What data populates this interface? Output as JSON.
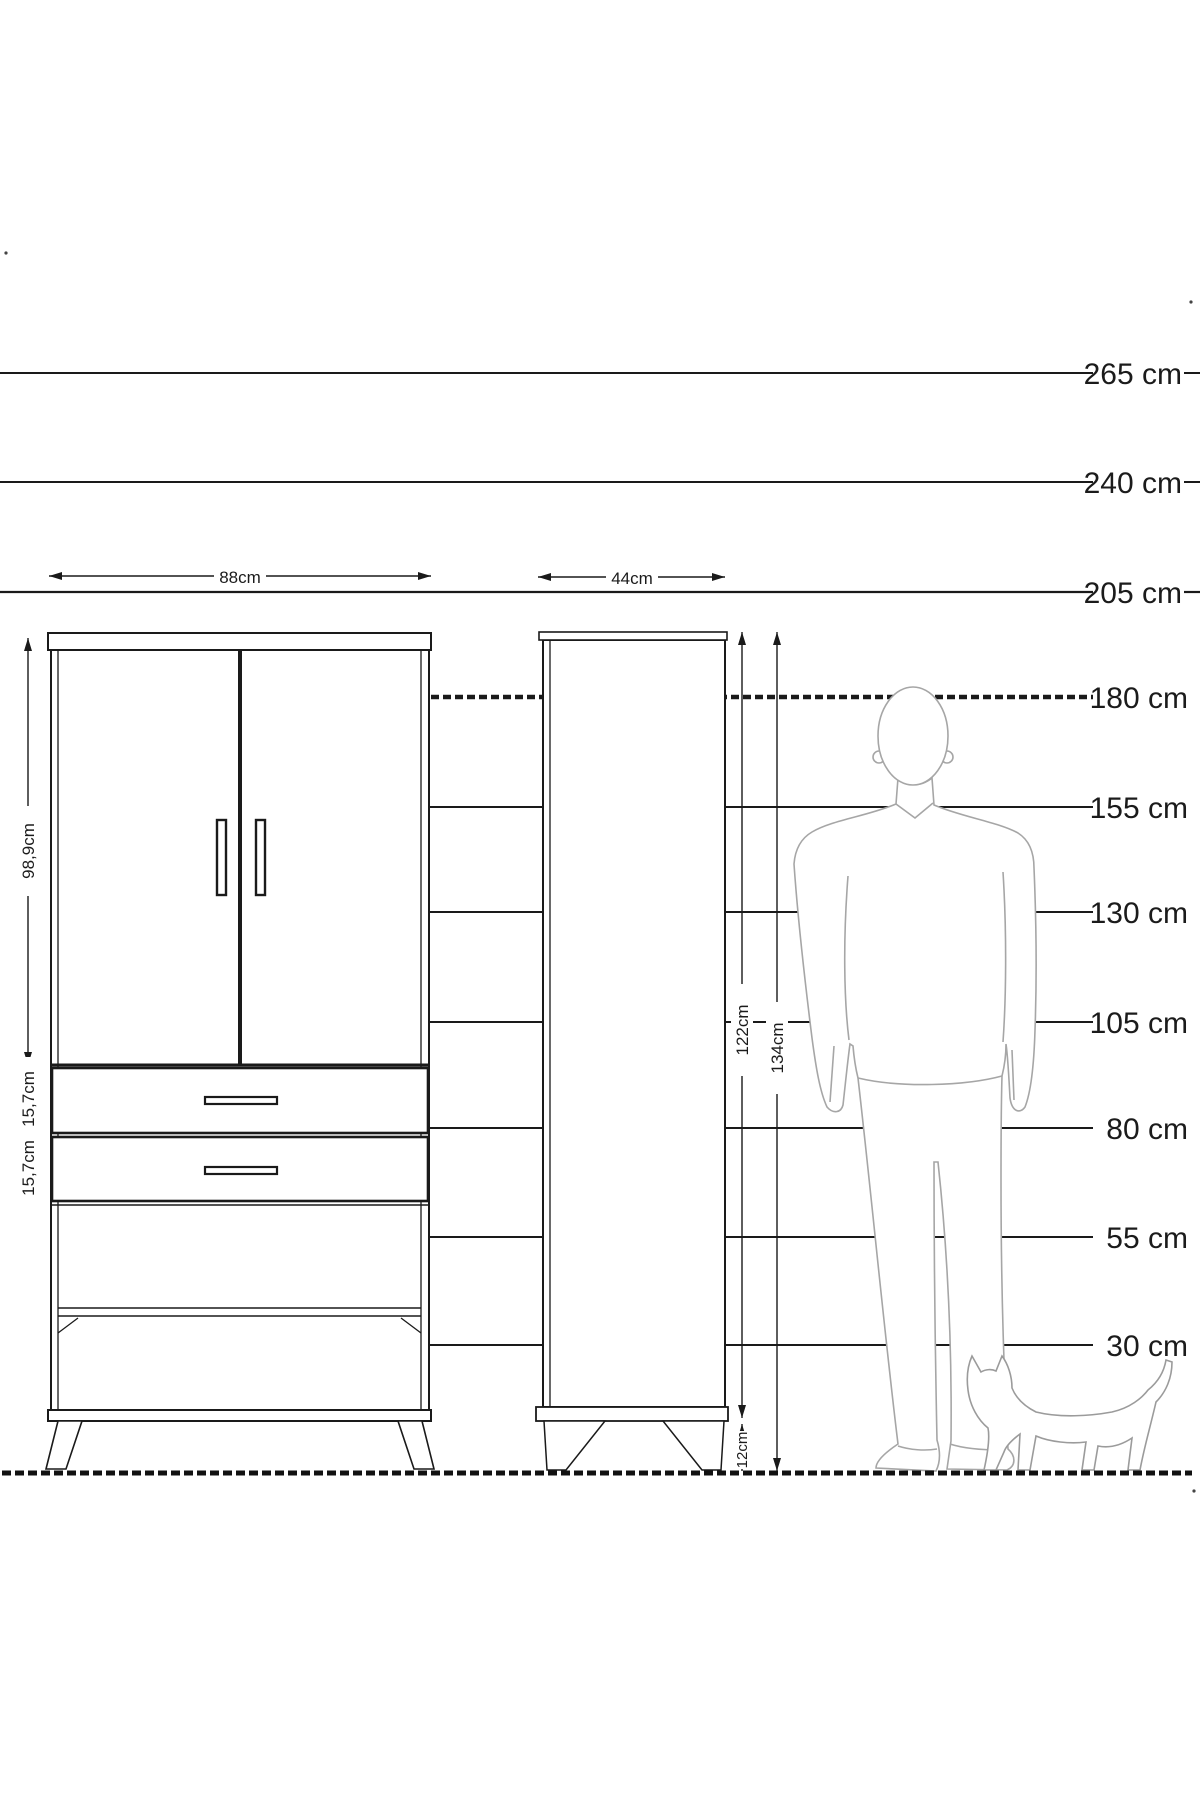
{
  "diagram": {
    "unit": "cm",
    "scale_labels": [
      {
        "label": "265 cm",
        "value": 265
      },
      {
        "label": "240 cm",
        "value": 240
      },
      {
        "label": "205 cm",
        "value": 205
      },
      {
        "label": "180 cm",
        "value": 180
      },
      {
        "label": "155 cm",
        "value": 155
      },
      {
        "label": "130 cm",
        "value": 130
      },
      {
        "label": "105 cm",
        "value": 105
      },
      {
        "label": "80 cm",
        "value": 80
      },
      {
        "label": "55 cm",
        "value": 55
      },
      {
        "label": "30 cm",
        "value": 30
      }
    ],
    "wardrobe": {
      "width": "88cm",
      "door_height": "98,9cm",
      "drawer_top": "15,7cm",
      "drawer_bottom": "15,7cm"
    },
    "cabinet": {
      "width": "44cm",
      "body_height": "122cm",
      "total_height": "134cm",
      "leg_height": "12cm"
    }
  }
}
